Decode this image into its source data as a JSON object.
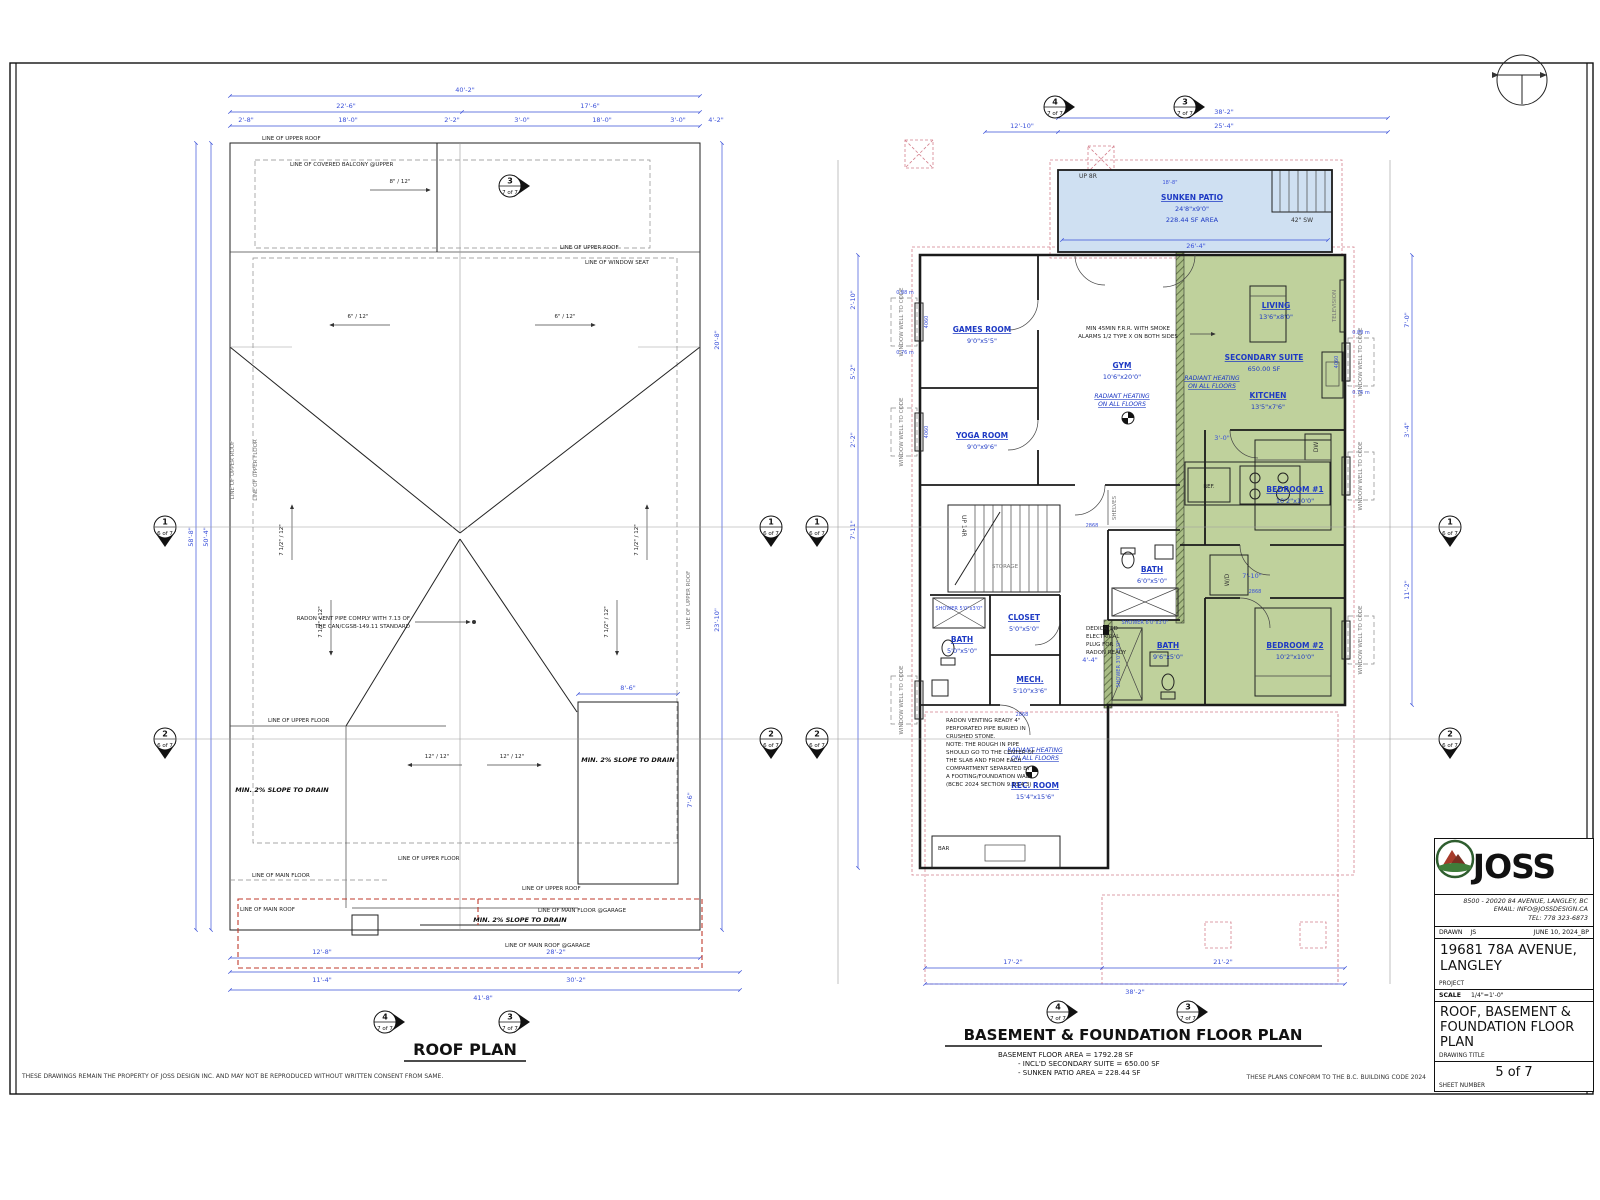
{
  "sheet": {
    "disclaimer": "THESE DRAWINGS REMAIN THE PROPERTY OF JOSS DESIGN INC. AND MAY NOT BE REPRODUCED WITHOUT WRITTEN CONSENT FROM SAME.",
    "code_note": "THESE PLANS CONFORM TO THE B.C. BUILDING CODE 2024"
  },
  "markers": {
    "one": {
      "num": "1",
      "sheet": "6 of 7"
    },
    "two": {
      "num": "2",
      "sheet": "6 of 7"
    },
    "three": {
      "num": "3",
      "sheet": "7 of 7"
    },
    "four": {
      "num": "4",
      "sheet": "7 of 7"
    }
  },
  "roof": {
    "title": "ROOF PLAN",
    "line_upper_roof": "LINE OF UPPER ROOF",
    "line_upper_floor": "LINE OF UPPER FLOOR",
    "line_covered_balcony": "LINE OF COVERED BALCONY @UPPER",
    "line_window_seat": "LINE OF WINDOW SEAT",
    "line_main_floor": "LINE OF MAIN FLOOR",
    "line_main_roof": "LINE OF MAIN ROOF",
    "line_main_floor_garage": "LINE OF MAIN FLOOR @GARAGE",
    "line_main_roof_garage": "LINE OF MAIN ROOF @GARAGE",
    "slope_to_drain": "MIN. 2% SLOPE TO DRAIN",
    "radon_note1": "RADON VENT PIPE COMPLY WITH 7.13 OF",
    "radon_note2": "THE CAN/CGSB-149.11 STANDARD",
    "slope_6_12": "6\" / 12\"",
    "slope_75_12": "7 1/2\" / 12\"",
    "slope_8_12": "8\" / 12\"",
    "slope_12_12": "12\" / 12\"",
    "dims": {
      "top_total": "40'-2\"",
      "top_left": "22'-6\"",
      "top_right": "17'-6\"",
      "s1": "2'-8\"",
      "s2": "18'-0\"",
      "s3": "2'-2\"",
      "s4": "3'-0\"",
      "s5": "4'-2\"",
      "left_total": "58'-8\"",
      "left_inner": "50'-4\"",
      "right_1": "20'-8\"",
      "right_2": "23'-10\"",
      "bot_total": "41'-8\"",
      "bot_l1": "11'-4\"",
      "bot_r1": "30'-2\"",
      "bot_l2": "12'-8\"",
      "bot_r2": "28'-2\"",
      "box_w": "8'-6\"",
      "box_h": "7'-6\""
    }
  },
  "basement": {
    "title": "BASEMENT & FOUNDATION FLOOR PLAN",
    "area1": "BASEMENT FLOOR AREA = 1792.28 SF",
    "area2": "- INCL'D SECONDARY SUITE = 650.00 SF",
    "area3": "- SUNKEN PATIO AREA = 228.44 SF",
    "patio": {
      "name": "SUNKEN PATIO",
      "size": "24'8\"x9'0\"",
      "area": "228.44 SF AREA"
    },
    "rooms": {
      "games": {
        "name": "GAMES ROOM",
        "size": "9'0\"x5'5\""
      },
      "yoga": {
        "name": "YOGA ROOM",
        "size": "9'0\"x9'6\""
      },
      "gym": {
        "name": "GYM",
        "size": "10'6\"x20'0\""
      },
      "living": {
        "name": "LIVING",
        "size": "13'6\"x8'0\""
      },
      "suite": {
        "name": "SECONDARY SUITE",
        "size": "650.00 SF"
      },
      "kitchen": {
        "name": "KITCHEN",
        "size": "13'5\"x7'6\""
      },
      "bed1": {
        "name": "BEDROOM #1",
        "size": "10'2\"x10'0\""
      },
      "bed2": {
        "name": "BEDROOM #2",
        "size": "10'2\"x10'0\""
      },
      "bath_suite": {
        "name": "BATH",
        "size": "9'6\"x5'0\""
      },
      "bath_hall": {
        "name": "BATH",
        "size": "6'0\"x5'0\""
      },
      "bath_left": {
        "name": "BATH",
        "size": "5'0\"x5'0\""
      },
      "closet": {
        "name": "CLOSET",
        "size": "5'0\"x5'0\""
      },
      "mech": {
        "name": "MECH.",
        "size": "5'10\"x3'6\""
      },
      "rec": {
        "name": "REC. ROOM",
        "size": "15'4\"x15'6\""
      }
    },
    "radiant1": "RADIANT HEATING",
    "radiant2": "ON ALL FLOORS",
    "labels": {
      "storage": "STORAGE",
      "bar": "BAR",
      "ref": "REF.",
      "dw": "DW",
      "wd": "W/D",
      "television": "TELEVISION",
      "shelves": "SHELVES",
      "up14r": "UP 14R",
      "up8r": "UP 8R",
      "sw42": "42\" SW",
      "window_well": "WINDOW WELL TO CODE",
      "shower_left": "SHOWER 5'0\"x3'0\"",
      "shower_hall": "SHOWER 6'0\"x3'0\"",
      "shower_suite": "SHOWER 3'0\"x5'0\""
    },
    "fr_note1": "MIN 45MIN F.R.R. WITH SMOKE",
    "fr_note2": "ALARMS 1/2 TYPE X ON BOTH SIDES",
    "radon_lines": [
      "RADON VENTING READY 4\"",
      "PERFORATED PIPE BURIED IN",
      "CRUSHED STONE.",
      "NOTE: THE ROUGH IN PIPE",
      "SHOULD GO TO THE CENTER OF",
      "THE SLAB AND FROM EACH",
      "COMPARTMENT SEPARATED BY",
      "A FOOTING/FOUNDATION WALL.",
      "(BCBC 2024 SECTION 9.13.4.3)"
    ],
    "elec_lines": [
      "DEDICATED",
      "ELECTRICAL",
      "PLUG FOR",
      "RADON READY"
    ],
    "tags": {
      "w4060": "4060",
      "d2868": "2868",
      "m088": "0.88 m",
      "m076": "0.76 m"
    },
    "dims": {
      "top_total": "38'-2\"",
      "top_left": "12'-10\"",
      "top_right": "25'-4\"",
      "patio_inner": "26'-4\"",
      "patio_top": "18'-8\"",
      "bot_left": "17'-2\"",
      "bot_right": "21'-2\"",
      "bot_total": "38'-2\"",
      "l1": "2'-10\"",
      "l2": "5'-2\"",
      "l3": "2'-2\"",
      "l4": "7'-11\"",
      "r1": "7'-0\"",
      "r2": "3'-4\"",
      "r3": "11'-2\"",
      "int1": "4'-4\"",
      "int2": "7'-10\"",
      "int3": "3'-0\""
    }
  },
  "title_block": {
    "brand": "JOSS",
    "addr1": "8500 - 20020 84 AVENUE, LANGLEY, BC",
    "addr2": "EMAIL: INFO@JOSSDESIGN.CA",
    "addr3": "TEL: 778 323-6873",
    "drawn_label": "DRAWN",
    "drawn": "JS",
    "date": "JUNE 10, 2024_BP",
    "project": "19681 78A AVENUE, LANGLEY",
    "project_label": "PROJECT",
    "scale_label": "SCALE",
    "scale": "1/4\"=1'-0\"",
    "title": "ROOF, BASEMENT & FOUNDATION FLOOR PLAN",
    "title_label": "DRAWING TITLE",
    "sheet": "5 of 7",
    "sheet_label": "SHEET NUMBER"
  }
}
